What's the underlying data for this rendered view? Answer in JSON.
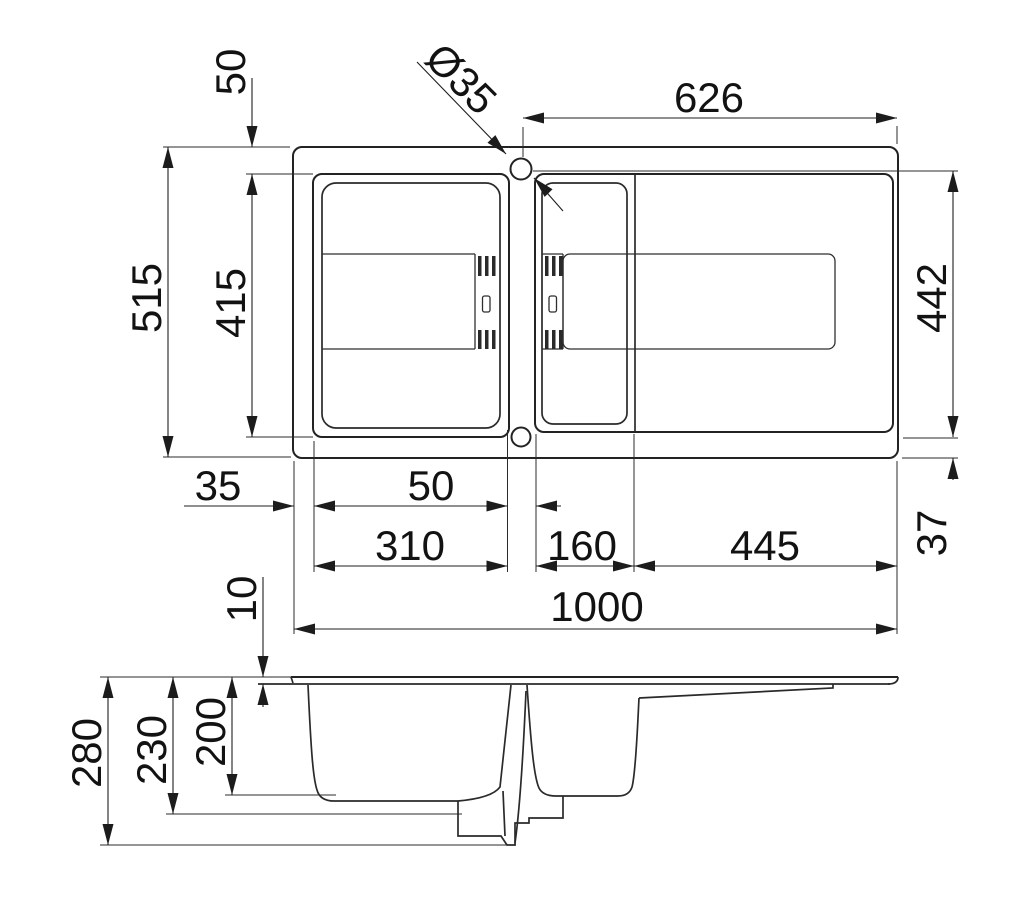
{
  "drawing": {
    "kind": "kitchen-sink-technical-drawing",
    "views": {
      "top": "plan-view",
      "bottom": "side-section-view"
    },
    "colors": {
      "line": "#222222",
      "background": "#ffffff"
    }
  },
  "dims": {
    "tap_hole_diameter": "Ø35",
    "bowl_top_offset": "50",
    "tap_hole_to_right_edge": "626",
    "overall_width": "515",
    "main_bowl_front_back": "415",
    "recess_front_back": "442",
    "left_rim_width": "35",
    "bowl_spacing": "50",
    "main_bowl_width": "310",
    "small_bowl_width": "160",
    "drainer_length": "445",
    "bottom_rim_width": "37",
    "overall_length": "1000",
    "rim_thickness": "10",
    "overall_height": "280",
    "bowl_outer_depth": "230",
    "bowl_inner_depth": "200"
  }
}
